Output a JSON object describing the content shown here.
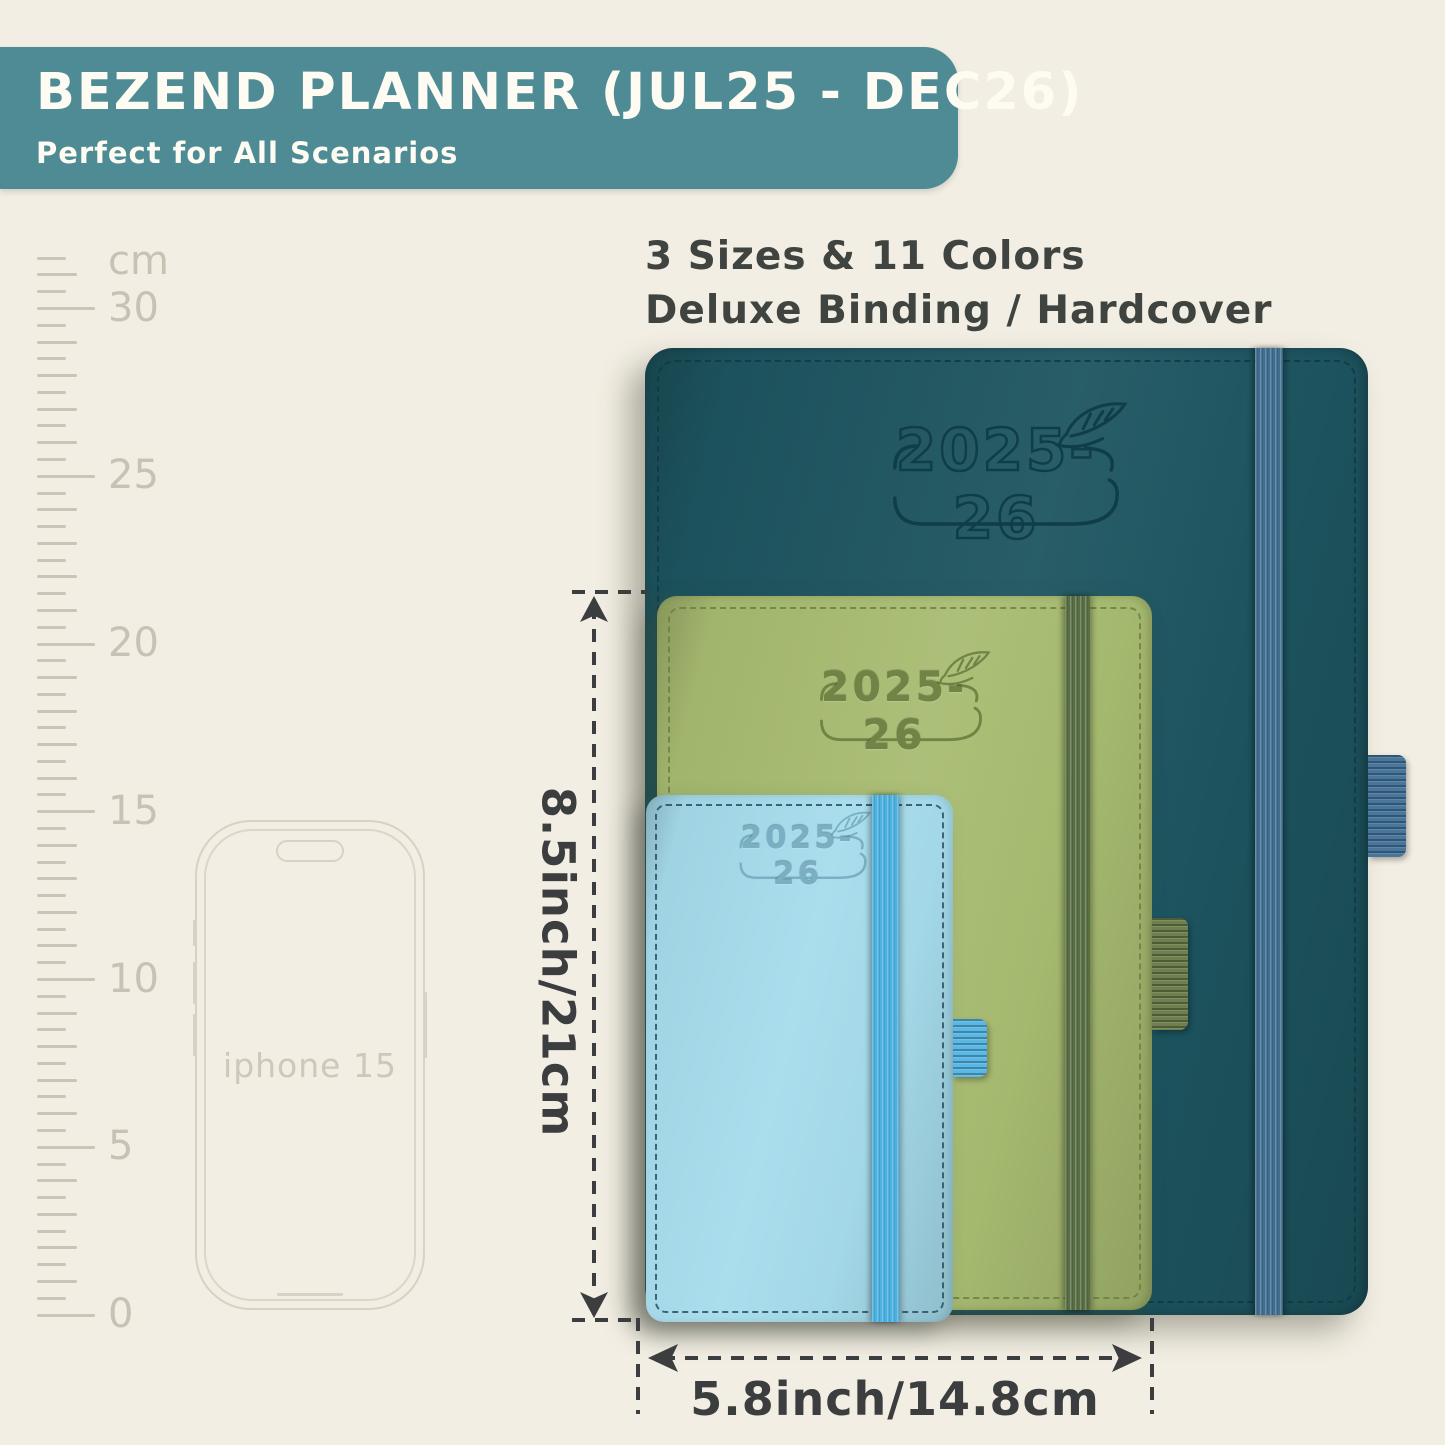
{
  "page": {
    "background_color": "#f2eee3",
    "dimension_color": "#3b3d3e"
  },
  "banner": {
    "title": "BEZEND PLANNER (JUL25 - DEC26)",
    "subtitle": "Perfect for All Scenarios",
    "background_color": "#4e8b95",
    "text_color": "#fdfbf2"
  },
  "headline": {
    "line1": "3 Sizes & 11 Colors",
    "line2": "Deluxe Binding / Hardcover"
  },
  "ruler": {
    "unit_label": "cm",
    "numbers": [
      {
        "label": "30",
        "cm": 30
      },
      {
        "label": "25",
        "cm": 25
      },
      {
        "label": "20",
        "cm": 20
      },
      {
        "label": "15",
        "cm": 15
      },
      {
        "label": "10",
        "cm": 10
      },
      {
        "label": "5",
        "cm": 5
      },
      {
        "label": "0",
        "cm": 0
      }
    ]
  },
  "phone": {
    "label": "iphone 15"
  },
  "planners": [
    {
      "size": "large",
      "year_label": "2025-26",
      "cover_color": "#1d5560",
      "band_color": "#406e91",
      "loop_color": "#48769c",
      "deboss_color": "#0f3d48",
      "stitch_color": "#0f3a44"
    },
    {
      "size": "medium",
      "year_label": "2025-26",
      "cover_color": "#a8bc71",
      "band_color": "#586f44",
      "loop_color": "#6e804d",
      "deboss_color": "#6f8445",
      "stitch_color": "#6d8142"
    },
    {
      "size": "small",
      "year_label": "2025-26",
      "cover_color": "#a6dcec",
      "band_color": "#4ab3e4",
      "loop_color": "#5ab8e6",
      "deboss_color": "#79b0c3",
      "stitch_color": "#2c4f63"
    }
  ],
  "dimensions": {
    "height_label": "8.5inch/21cm",
    "width_label": "5.8inch/14.8cm"
  }
}
